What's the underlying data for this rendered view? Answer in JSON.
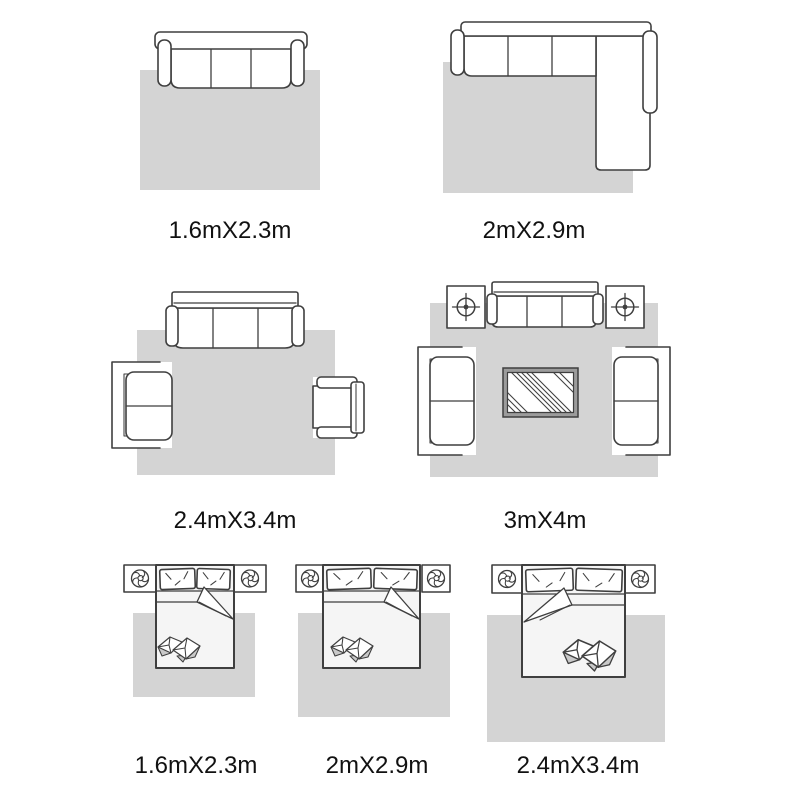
{
  "colors": {
    "background": "#ffffff",
    "rug": "#d4d4d4",
    "outline": "#3f3f3f",
    "bed_sheet": "#f5f5f5",
    "pillow_shade": "#c9c9c9",
    "table_border": "#9c9c9c",
    "label_text": "#111111"
  },
  "panels": [
    {
      "name": "sofa-on-rug",
      "label": "1.6mX2.3m"
    },
    {
      "name": "sectional-sofa-on-rug",
      "label": "2mX2.9m"
    },
    {
      "name": "living-room-set-on-rug",
      "label": "2.4mX3.4m"
    },
    {
      "name": "full-living-room-on-rug",
      "label": "3mX4m"
    },
    {
      "name": "bedroom-small-rug",
      "label": "1.6mX2.3m"
    },
    {
      "name": "bedroom-medium-rug",
      "label": "2mX2.9m"
    },
    {
      "name": "bedroom-large-rug",
      "label": "2.4mX3.4m"
    }
  ]
}
